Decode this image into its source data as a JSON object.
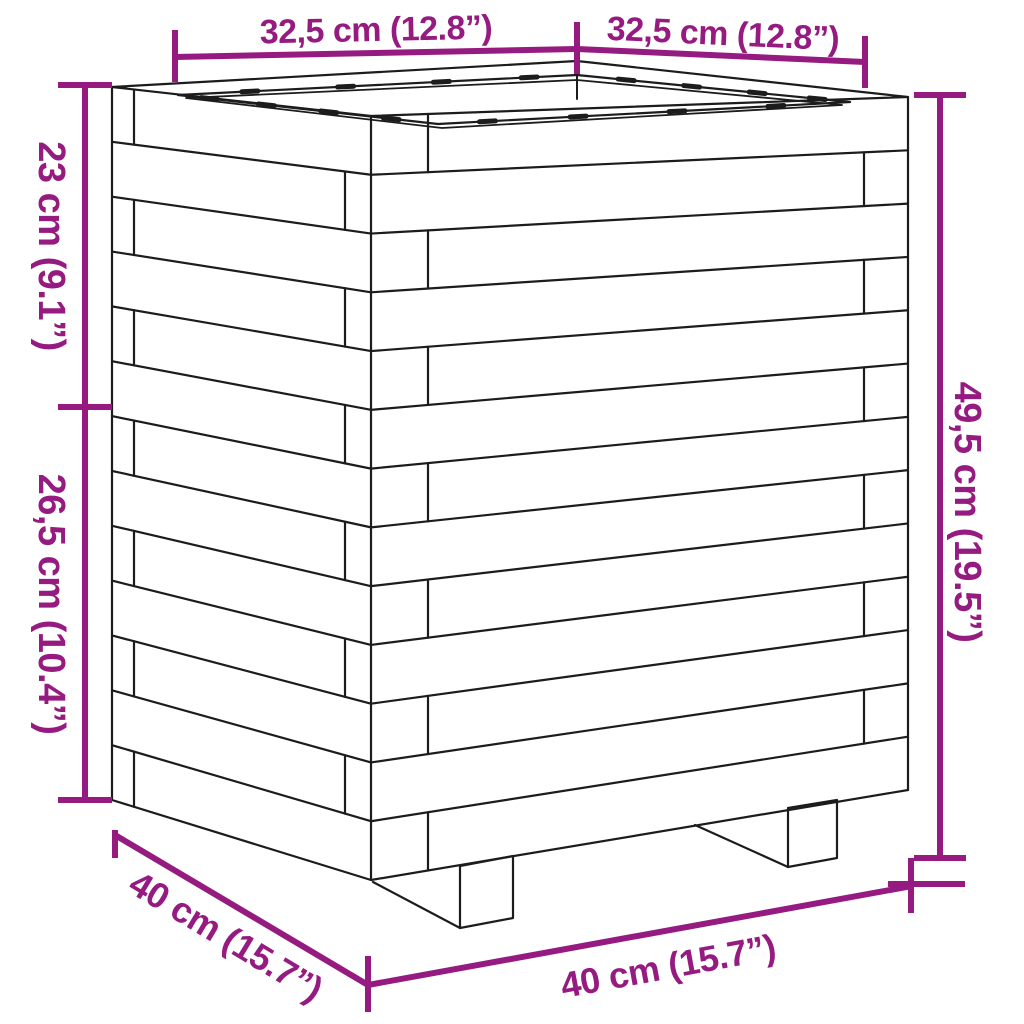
{
  "figure": {
    "subject": "slatted wooden garden planter",
    "style": "technical line drawing with dimension callouts",
    "visible_feet": 2,
    "visible_faces": 2
  },
  "colors": {
    "dimension": "#951b81",
    "line": "#1c1c1c",
    "background": "#ffffff"
  },
  "dimensions": {
    "top_left_width": {
      "label": "32,5 cm (12.8”)",
      "cm": "32,5",
      "inches": "12.8"
    },
    "top_right_width": {
      "label": "32,5 cm (12.8”)",
      "cm": "32,5",
      "inches": "12.8"
    },
    "left_upper_height": {
      "label": "23 cm (9.1”)",
      "cm": "23",
      "inches": "9.1"
    },
    "left_lower_height": {
      "label": "26,5 cm (10.4”)",
      "cm": "26,5",
      "inches": "10.4"
    },
    "right_total_height": {
      "label": "49,5 cm (19.5”)",
      "cm": "49,5",
      "inches": "19.5"
    },
    "bottom_side_depth": {
      "label": "40 cm (15.7”)",
      "cm": "40",
      "inches": "15.7"
    },
    "bottom_front_width": {
      "label": "40 cm (15.7”)",
      "cm": "40",
      "inches": "15.7"
    }
  }
}
